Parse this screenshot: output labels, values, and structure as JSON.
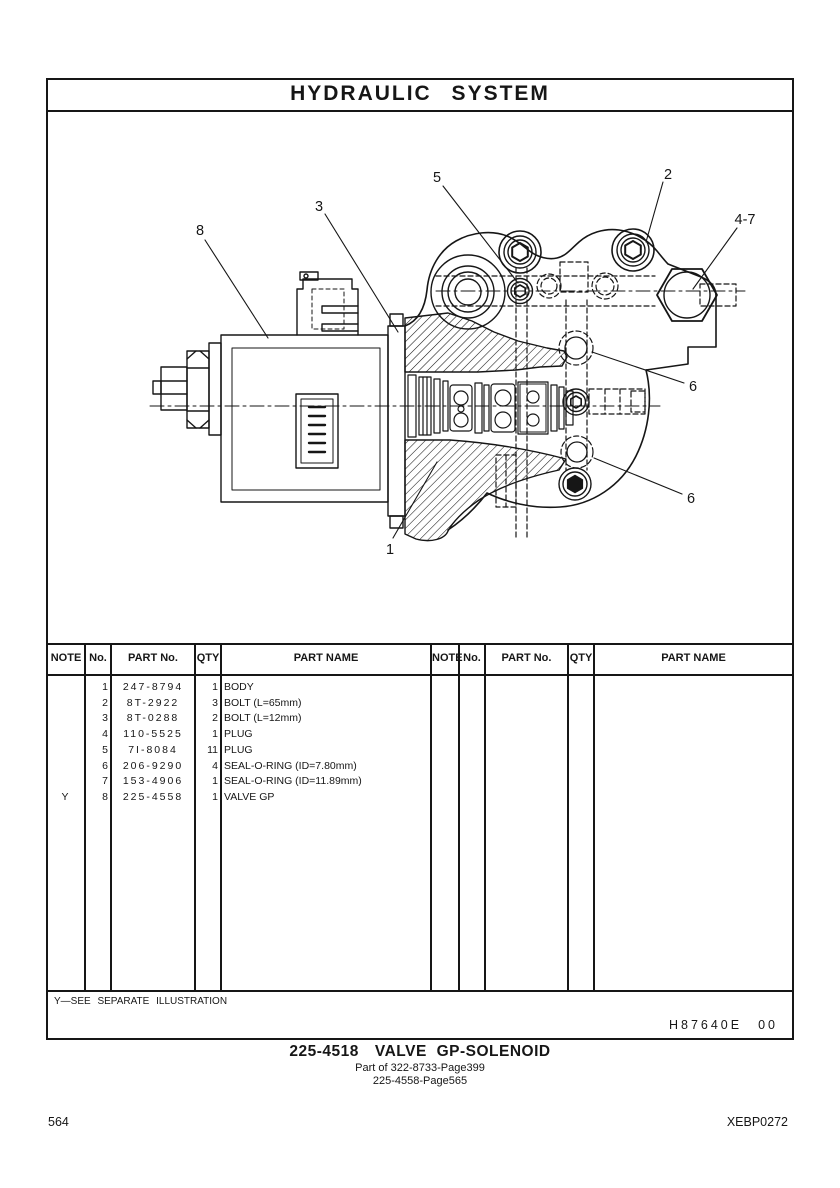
{
  "page": {
    "title": "HYDRAULIC  SYSTEM",
    "footer_left": "564",
    "footer_right": "XEBP0272"
  },
  "figure": {
    "description": "cross-section drawing of solenoid valve group mounted on hydraulic manifold body",
    "callouts": {
      "body": "1",
      "bolt_top": "2",
      "adapter_plate": "3",
      "plug_range": "4-7",
      "plug_small": "5",
      "seal_upper": "6",
      "seal_lower": "6",
      "solenoid": "8"
    },
    "footnote": "Y—SEE  SEPARATE  ILLUSTRATION",
    "ref_code": "H87640E",
    "ref_rev": "00"
  },
  "caption": {
    "part_no": "225-4518",
    "name": "VALVE  GP-SOLENOID",
    "sub1": "Part of 322-8733-Page399",
    "sub2": "225-4558-Page565"
  },
  "table": {
    "headers": {
      "note": "NOTE",
      "no": "No.",
      "part_no": "PART No.",
      "qty": "QTY",
      "part_name": "PART NAME"
    },
    "rows": [
      {
        "note": "",
        "no": "1",
        "part_no": "247-8794",
        "qty": "1",
        "name": "BODY"
      },
      {
        "note": "",
        "no": "2",
        "part_no": "8T-2922",
        "qty": "3",
        "name": "BOLT (L=65mm)"
      },
      {
        "note": "",
        "no": "3",
        "part_no": "8T-0288",
        "qty": "2",
        "name": "BOLT (L=12mm)"
      },
      {
        "note": "",
        "no": "4",
        "part_no": "110-5525",
        "qty": "1",
        "name": "PLUG"
      },
      {
        "note": "",
        "no": "5",
        "part_no": "7I-8084",
        "qty": "11",
        "name": "PLUG"
      },
      {
        "note": "",
        "no": "6",
        "part_no": "206-9290",
        "qty": "4",
        "name": "SEAL-O-RING (ID=7.80mm)"
      },
      {
        "note": "",
        "no": "7",
        "part_no": "153-4906",
        "qty": "1",
        "name": "SEAL-O-RING (ID=11.89mm)"
      },
      {
        "note": "Y",
        "no": "8",
        "part_no": "225-4558",
        "qty": "1",
        "name": "VALVE  GP"
      }
    ]
  }
}
